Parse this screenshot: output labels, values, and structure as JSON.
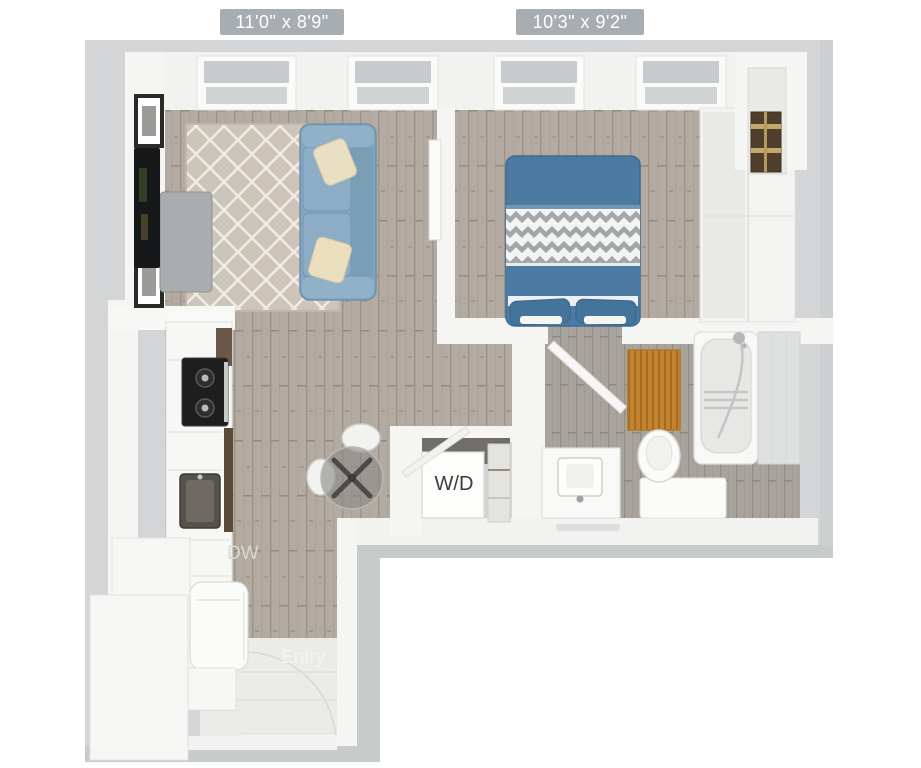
{
  "floorplan": {
    "title": "Studio apartment 3D floor plan",
    "dimension_labels": [
      {
        "room": "living-room",
        "text": "11'0\" x 8'9\""
      },
      {
        "room": "bedroom",
        "text": "10'3\" x 9'2\""
      }
    ],
    "room_labels": {
      "washer_dryer": "W/D",
      "dishwasher": "DW",
      "entry": "Entry"
    },
    "colors": {
      "page_background": "#ffffff",
      "slab_gray": "#d3d5d6",
      "slab_shadow": "#c8cbcc",
      "wall_white": "#f5f5f3",
      "wood_floor": "#b3aaa1",
      "bath_floor": "#a8a49d",
      "entry_tile": "#ebebe9",
      "rug_beige": "#cdc4ba",
      "sofa_blue": "#84a7c0",
      "bed_blue": "#4b7ba3",
      "pillow_cream": "#e9dfc2",
      "chevron_gray": "#a2a7aa",
      "bath_mat_orange": "#c4832e",
      "suitcase_brown": "#4f3e2c",
      "badge_gray": "#a8adb2",
      "badge_text": "#ffffff",
      "wd_text": "#3b3b3b"
    }
  }
}
